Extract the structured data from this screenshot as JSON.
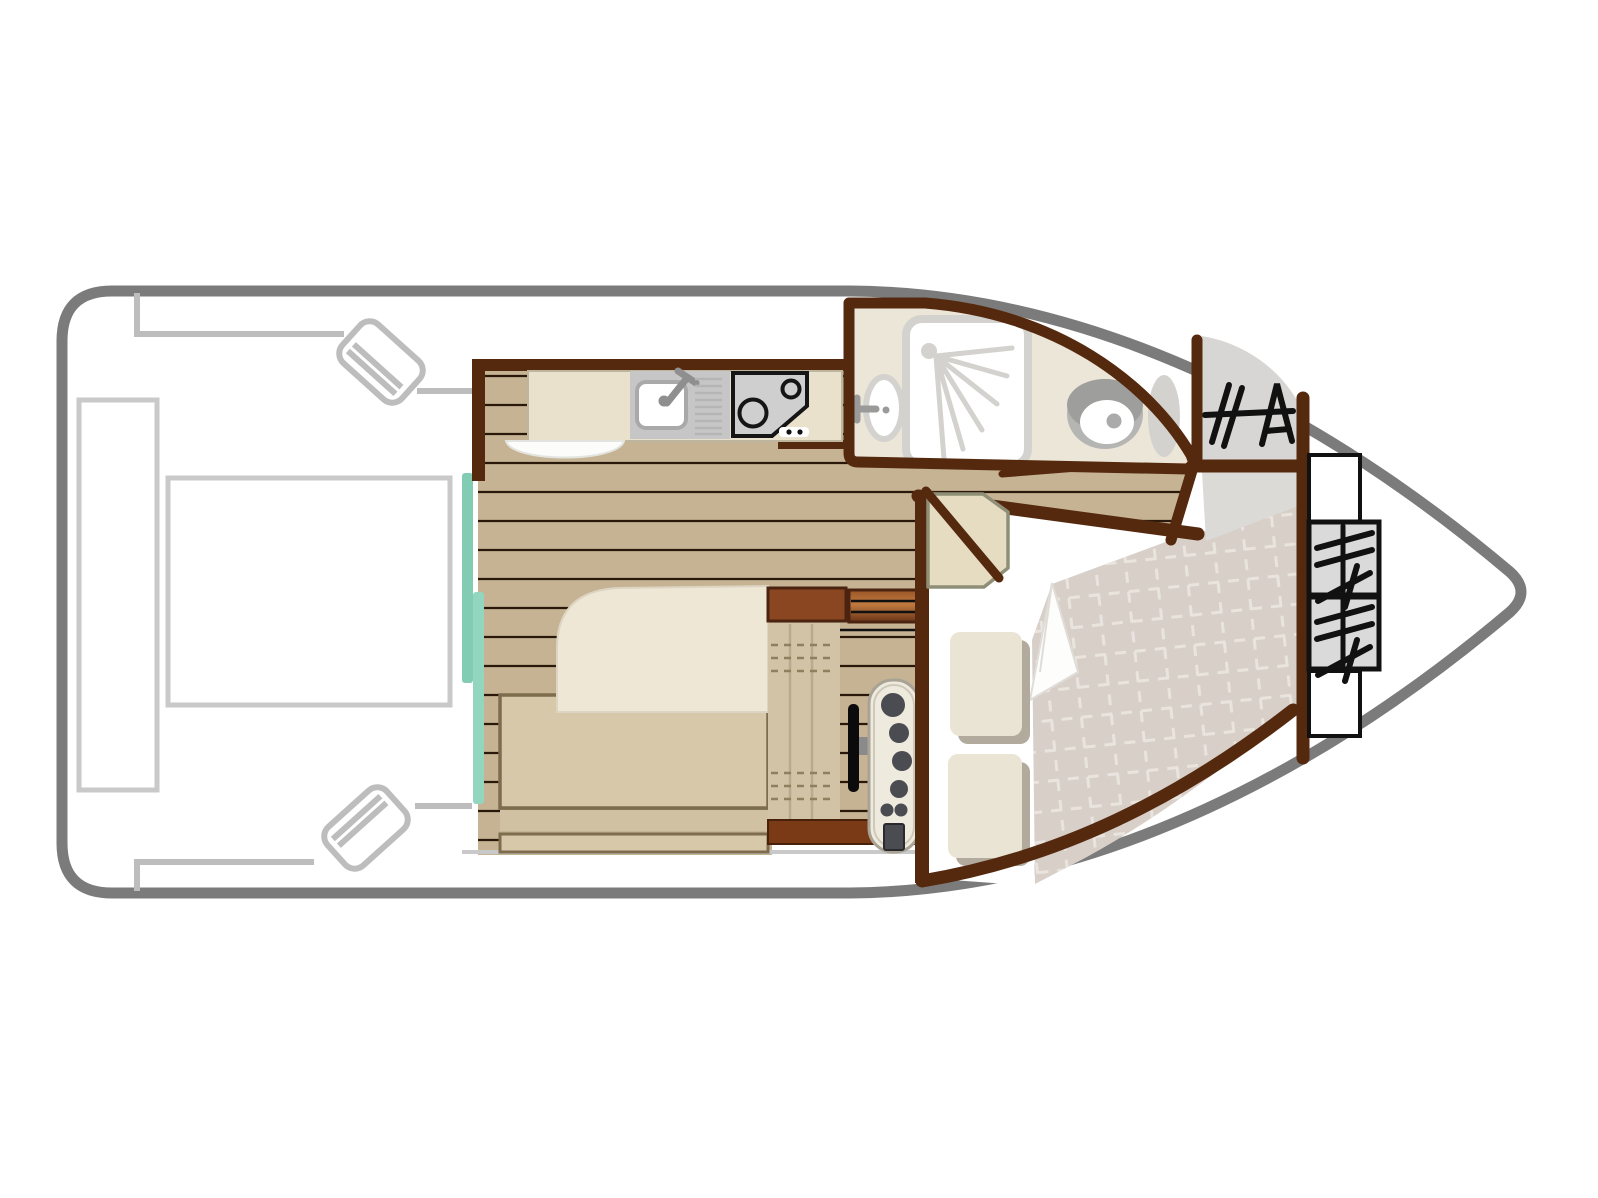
{
  "diagram": {
    "type": "boat-floorplan-top-view",
    "regions": [
      {
        "name": "stern-deck",
        "items": [
          "deck-bench",
          "deck-table",
          "boarding-step-top",
          "boarding-step-bottom"
        ]
      },
      {
        "name": "saloon",
        "items": [
          "dinette-table",
          "bench-seat",
          "lower-bench",
          "storage-cabinet",
          "drawer-unit",
          "window-strips"
        ]
      },
      {
        "name": "kitchen",
        "items": [
          "counter",
          "sink",
          "faucet",
          "drainboard",
          "stove-two-burners",
          "floor-mat"
        ]
      },
      {
        "name": "helm",
        "items": [
          "helm-seat",
          "steering-wheel",
          "dashboard-gauges"
        ]
      },
      {
        "name": "bathroom",
        "items": [
          "shower-tray",
          "shower-spray",
          "washbasin",
          "toilet",
          "vanity-ellipse",
          "door-threshold"
        ]
      },
      {
        "name": "wardrobe",
        "items": [
          "hanger-icon"
        ]
      },
      {
        "name": "bow-cabin",
        "items": [
          "double-bed",
          "duvet-grid",
          "duvet-fold",
          "pillow-1",
          "pillow-2",
          "cabin-door",
          "entry-floor"
        ]
      },
      {
        "name": "bow-lockers",
        "items": [
          "shelf-top",
          "hanger-locker-1",
          "hanger-locker-2",
          "shelf-bottom",
          "hanger-rail"
        ]
      }
    ]
  },
  "colors": {
    "hull": "#7b7b7b",
    "deck_line": "#bdbdbd",
    "deck_rect": "#c9c9c9",
    "wall": "#55290e",
    "wall_red": "#7a3a16",
    "wood": "#c5b393",
    "plank": "#2a190b",
    "counter": "#e9e1cc",
    "counter_edge": "#bdb59d",
    "appliance": "#c6c6c6",
    "steel": "#8f8f8f",
    "stove_line": "#151515",
    "bath_floor": "#ece6d8",
    "fixture_gray": "#d3d2ce",
    "toilet_gray": "#b5b5b3",
    "toilet_dark": "#9e9e9c",
    "teal": "#82ccb4",
    "teal2": "#93d6c0",
    "wardrobe": "#d8d6d4",
    "entry_gray": "#dcdad7",
    "duvet": "#d8cfc9",
    "grid_line": "#eae4de",
    "sheet": "#ffffff",
    "pillow": "#eae4d4",
    "pillow_shadow": "#b2ab9d",
    "bench": "#d6c8a9",
    "bench_light": "#cfc1a2",
    "bench_border": "#7d6c4d",
    "table": "#eee7d6",
    "table_edge": "#ddd5c2",
    "cabinet": "#8a4620",
    "cabinet_dark": "#4a2410",
    "seat": "#d2c3a6",
    "seat_line": "#b9aa8a",
    "stitch": "#8f7f5f",
    "wheel": "#0b0b0b",
    "dash_panel": "#eeeade",
    "dash_edge": "#a9a396",
    "gauge": "#4b4b52",
    "hanger": "#111111",
    "door_leaf": "#e6dcc2",
    "door_edge": "#8f8f78",
    "white": "#ffffff",
    "mat_edge": "#e3e3e0"
  }
}
